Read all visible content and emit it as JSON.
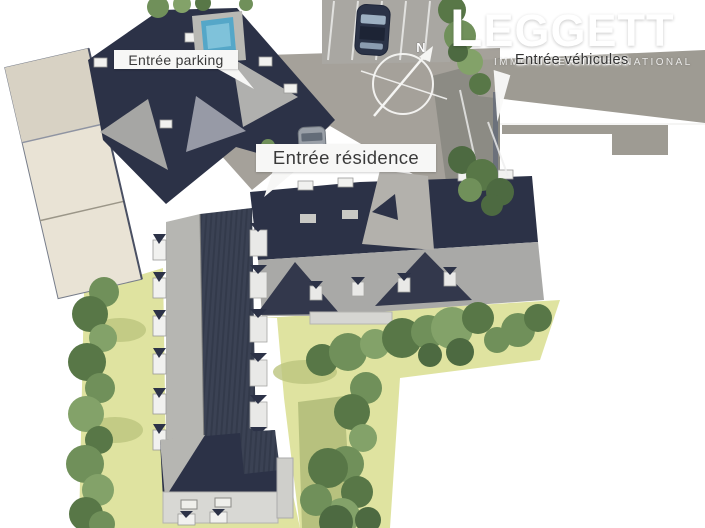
{
  "labels": {
    "parking": "Entrée parking",
    "residence": "Entrée résidence",
    "vehicles": "Entrée véhicules"
  },
  "logo": {
    "name": "LEGGETT",
    "tagline": "IMMOBILIER INTERNATIONAL"
  },
  "compass": {
    "north_label": "N"
  },
  "colors": {
    "roof_navy": "#2c3247",
    "roof_slate": "#3b4254",
    "roof_slate_dark": "#333a4b",
    "roof_gray": "#a9a9a7",
    "roof_gray2": "#b6b6b2",
    "garage_beige": "#e9e3d5",
    "garage_beige_dark": "#d8d2c4",
    "lawn": "#dfe3a0",
    "tree_green": "#70905a",
    "tree_green_dark": "#587747",
    "tree_green_light": "#83a269",
    "tree_green_deep": "#4d6a41",
    "road": "#9e9b93",
    "courtyard": "#a5a19a",
    "parking": "#a9a7a2",
    "pool": "#55a7c8",
    "label_bg": "#f7f7f6",
    "label_text": "#3a3a3a",
    "logo_white": "#ffffff",
    "car_navy": "#2b3347",
    "van_gray": "#9aa0a8"
  }
}
